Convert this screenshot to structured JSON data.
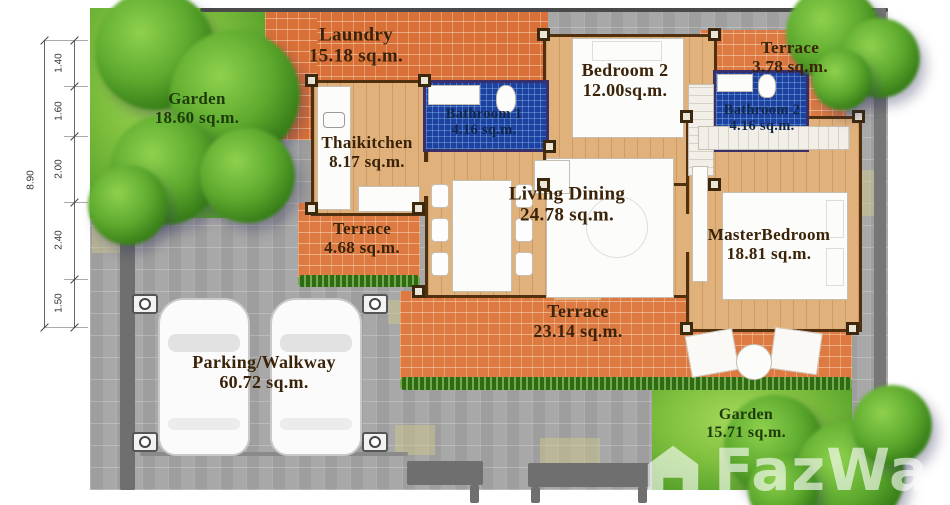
{
  "plan": {
    "rooms": {
      "garden_top": {
        "name": "Garden",
        "area": "18.60 sq.m."
      },
      "laundry": {
        "name": "Laundry",
        "area": "15.18 sq.m."
      },
      "terrace_ne": {
        "name": "Terrace",
        "area": "3.78 sq.m."
      },
      "bathroom1": {
        "name": "Bathroom 1",
        "area": "4.16 sq.m."
      },
      "bedroom2": {
        "name": "Bedroom 2",
        "area": "12.00sq.m."
      },
      "bathroom2": {
        "name": "Bathroom 2",
        "area": "4.16 sq.m."
      },
      "thaikitchen": {
        "name": "Thaikitchen",
        "area": "8.17 sq.m."
      },
      "terrace_kitchen": {
        "name": "Terrace",
        "area": "4.68 sq.m."
      },
      "living_dining": {
        "name": "Living Dining",
        "area": "24.78 sq.m."
      },
      "master_bedroom": {
        "name": "MasterBedroom",
        "area": "18.81 sq.m."
      },
      "terrace_south": {
        "name": "Terrace",
        "area": "23.14 sq.m."
      },
      "parking": {
        "name": "Parking/Walkway",
        "area": "60.72 sq.m."
      },
      "garden_se": {
        "name": "Garden",
        "area": "15.71 sq.m."
      }
    },
    "dimensions": {
      "total": "8.90",
      "segments": [
        "1.40",
        "1.60",
        "2.00",
        "2.40",
        "1.50"
      ]
    },
    "watermark": {
      "text": "FazWa",
      "logo": "fazwaz-house-logo"
    },
    "colors": {
      "brick_orange": "#dc7a42",
      "laundry_orange": "#d97038",
      "wood_floor": "#e1b17c",
      "paving_gray": "#a8a8a8",
      "grass_green": "#7fbf3e",
      "tile_blue": "#1e41a0",
      "wall_brown": "#50300f",
      "label_brown": "#3a2308",
      "garden_label_green": "#1d3c09",
      "hedge_green": "#2e6b17",
      "boundary_gray": "#6f6f6f"
    }
  }
}
